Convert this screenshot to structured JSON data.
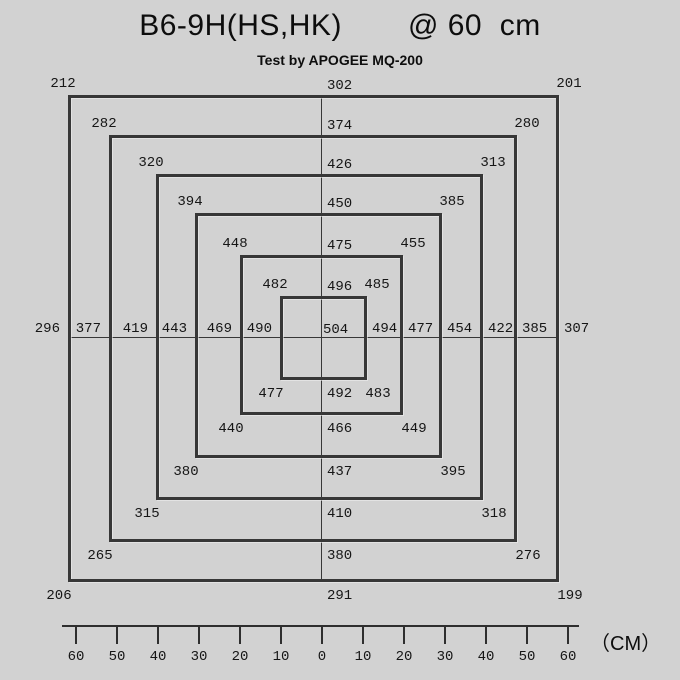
{
  "header": {
    "title_model": "B6-9H(HS,HK)",
    "title_distance": "@ 60  cm",
    "subtitle": "Test by APOGEE MQ-200"
  },
  "chart_data": {
    "type": "heatmap",
    "title": "B6-9H(HS,HK) @ 60 cm",
    "subtitle": "Test by APOGEE MQ-200",
    "description": "Light intensity readings on concentric square rings around the fixture center, measured at 60 cm height",
    "center_value": "504",
    "rings": [
      {
        "distance_cm": 10,
        "top_left": "482",
        "top": "496",
        "top_right": "485",
        "left": "490",
        "right": "494",
        "bottom_left": "477",
        "bottom": "492",
        "bottom_right": "483"
      },
      {
        "distance_cm": 20,
        "top_left": "448",
        "top": "475",
        "top_right": "455",
        "left": "469",
        "right": "477",
        "bottom_left": "440",
        "bottom": "466",
        "bottom_right": "449"
      },
      {
        "distance_cm": 30,
        "top_left": "394",
        "top": "450",
        "top_right": "385",
        "left": "443",
        "right": "454",
        "bottom_left": "380",
        "bottom": "437",
        "bottom_right": "395"
      },
      {
        "distance_cm": 40,
        "top_left": "320",
        "top": "426",
        "top_right": "313",
        "left": "419",
        "right": "422",
        "bottom_left": "315",
        "bottom": "410",
        "bottom_right": "318"
      },
      {
        "distance_cm": 50,
        "top_left": "282",
        "top": "374",
        "top_right": "280",
        "left": "377",
        "right": "385",
        "bottom_left": "265",
        "bottom": "380",
        "bottom_right": "276"
      },
      {
        "distance_cm": 60,
        "top_left": "212",
        "top": "302",
        "top_right": "201",
        "left": "296",
        "right": "307",
        "bottom_left": "206",
        "bottom": "291",
        "bottom_right": "199"
      }
    ],
    "axis_ticks": [
      "60",
      "50",
      "40",
      "30",
      "20",
      "10",
      "0",
      "10",
      "20",
      "30",
      "40",
      "50",
      "60"
    ],
    "axis_unit": "（CM）",
    "legend_position": "none",
    "grid": "crosshair"
  },
  "colors": {
    "background": "#d2d2d2",
    "line": "#373737",
    "text": "#121212"
  }
}
